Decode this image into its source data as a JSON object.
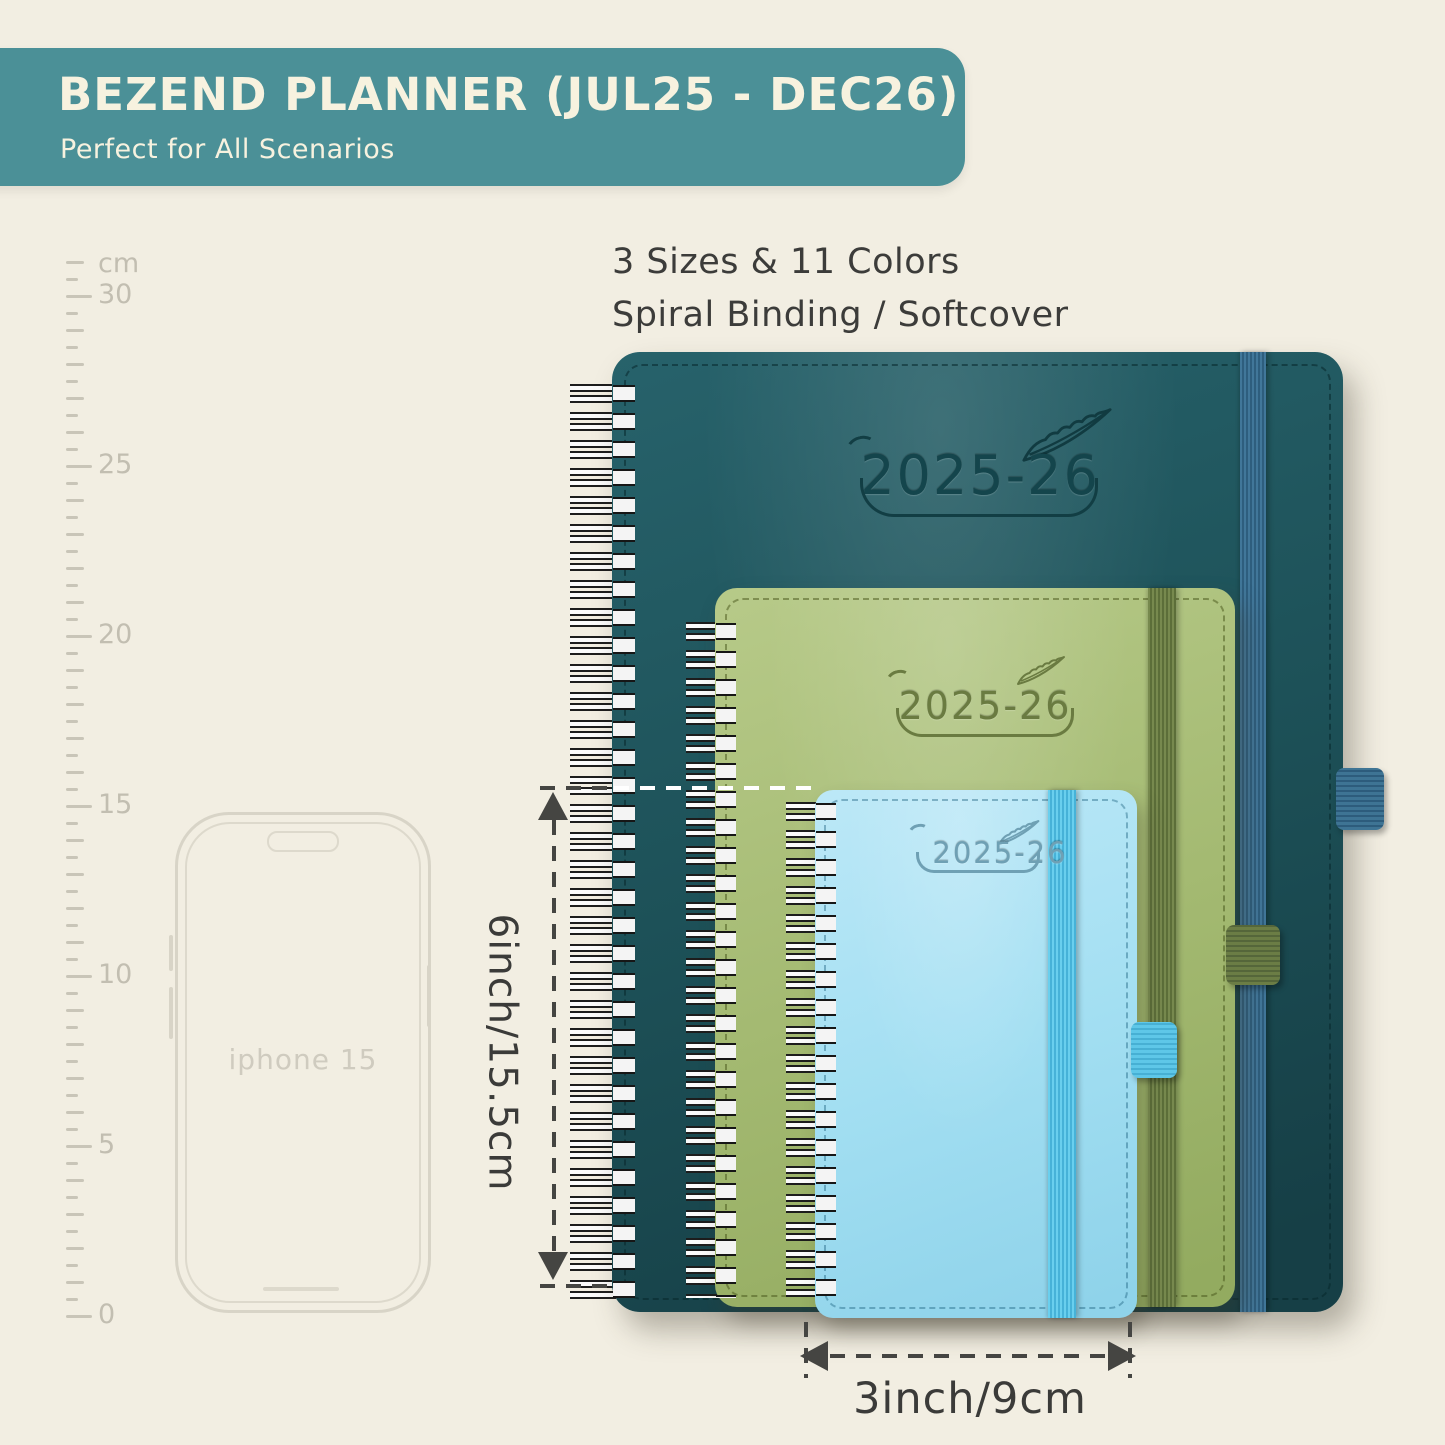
{
  "banner": {
    "title": "BEZEND PLANNER (JUL25 - DEC26)",
    "subtitle": "Perfect for All Scenarios",
    "bg_color": "#4b9097",
    "text_color": "#f7f2df"
  },
  "info": {
    "line1": "3 Sizes & 11 Colors",
    "line2": "Spiral Binding / Softcover"
  },
  "ruler": {
    "unit_label": "cm",
    "labels": [
      "30",
      "25",
      "20",
      "15",
      "10",
      "5",
      "0"
    ]
  },
  "phone": {
    "label": "iphone 15"
  },
  "planners": [
    {
      "name": "large-teal-planner",
      "label": "2025-26",
      "cover_color": "#1f5459",
      "band_color": "#3e7494",
      "logo_color": "#14454c"
    },
    {
      "name": "medium-green-planner",
      "label": "2025-26",
      "cover_color": "#a4ba72",
      "band_color": "#68793f",
      "logo_color": "#6a7b41"
    },
    {
      "name": "small-blue-planner",
      "label": "2025-26",
      "cover_color": "#a3dff2",
      "band_color": "#52bfe2",
      "logo_color": "#6fa0b4"
    }
  ],
  "measurements": {
    "height_label": "6inch/15.5cm",
    "width_label": "3inch/9cm"
  }
}
